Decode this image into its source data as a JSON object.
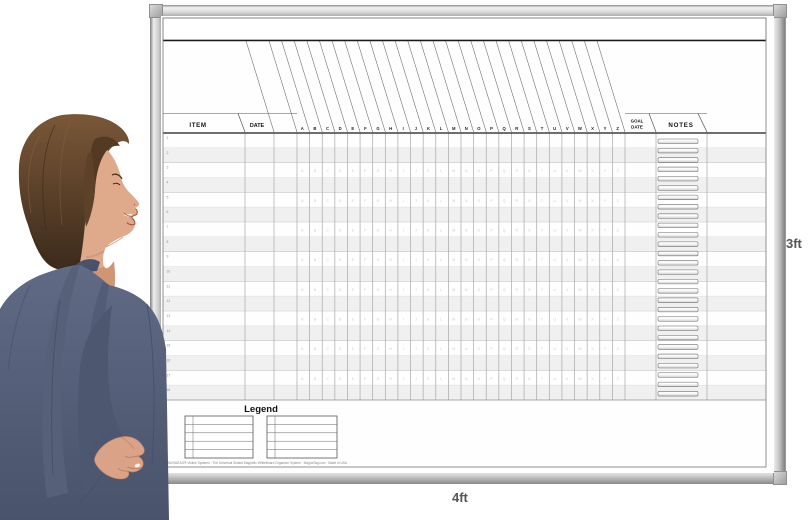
{
  "dimension_labels": {
    "height": "3ft",
    "width": "4ft"
  },
  "board": {
    "title_band_text": "",
    "header": {
      "item": "ITEM",
      "date": "DATE",
      "goal_line1": "GOAL",
      "goal_line2": "DATE",
      "notes": "NOTES"
    },
    "column_letters": [
      "A",
      "B",
      "C",
      "D",
      "E",
      "F",
      "G",
      "H",
      "I",
      "J",
      "K",
      "L",
      "M",
      "N",
      "O",
      "P",
      "Q",
      "R",
      "S",
      "T",
      "U",
      "V",
      "W",
      "X",
      "Y",
      "Z"
    ],
    "row_numbers": [
      "1",
      "2",
      "3",
      "4",
      "5",
      "6",
      "7",
      "8",
      "9",
      "10",
      "11",
      "12",
      "13",
      "14",
      "15",
      "16",
      "17",
      "18"
    ],
    "notes_strip_count": 28,
    "legend": {
      "title": "Legend",
      "tables": [
        {
          "rows": 5
        },
        {
          "rows": 5
        }
      ]
    },
    "fine_print": "©MAGNATAG® Visible Systems · The Universal Slotted Magnetic WhiteBoard Organizer System · MagnaTag.com · Made in USA"
  },
  "colors": {
    "frame_silver": "#cfcfcf",
    "surface": "#fefefe",
    "stripe": "#f0f0f0",
    "grid_line": "#a8a8a8",
    "header_line": "#1a1a1a",
    "label_text": "#555555",
    "blazer_blue": "#5d6781",
    "hair_brown": "#5f452e",
    "skin": "#dfa98c"
  }
}
